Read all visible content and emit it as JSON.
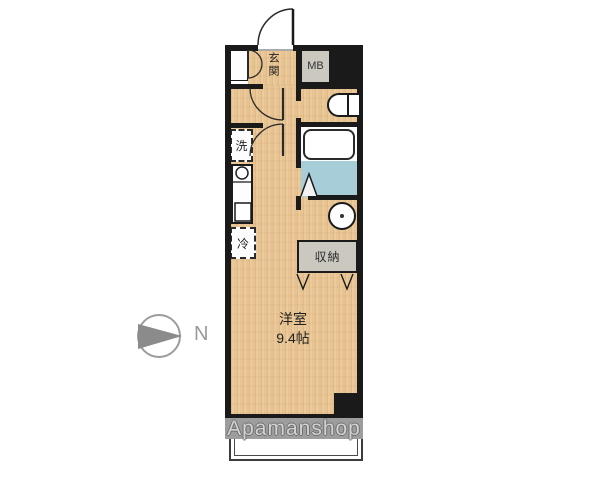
{
  "floorplan": {
    "entrance_label": "玄関",
    "meter_box_label": "MB",
    "laundry_label": "洗",
    "fridge_label": "冷",
    "storage_label": "収納",
    "room_name": "洋室",
    "room_size": "9.4帖",
    "compass_label": "N",
    "watermark": "Apamanshop"
  },
  "colors": {
    "wood_floor": "#e8c493",
    "wall_black": "#1a1a1a",
    "bathroom_floor_blue": "#a7cdd9",
    "utility_box_gray": "#cbc8c0",
    "watermark_band": "#9d9d9d",
    "watermark_text": "#d2d2d2",
    "compass_gray": "#9a9a9a"
  }
}
